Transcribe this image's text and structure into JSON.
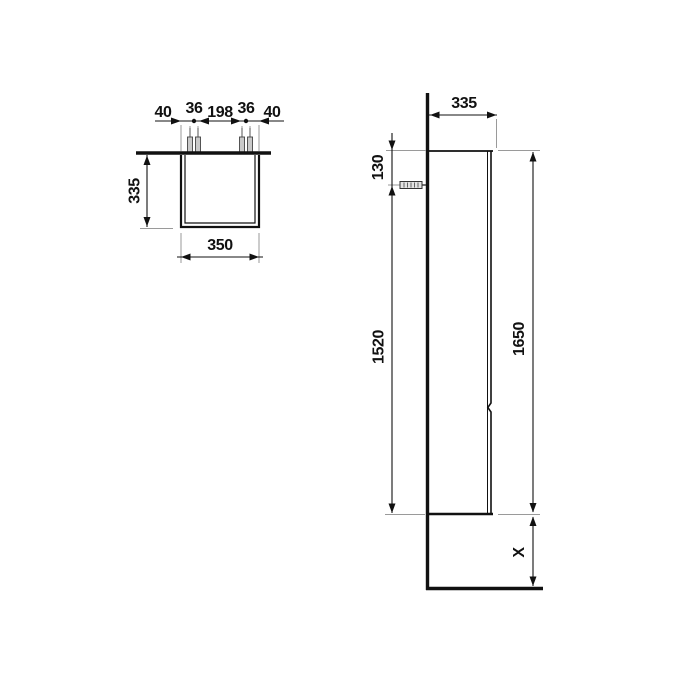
{
  "drawing": {
    "colors": {
      "line": "#111111",
      "extension_line": "#9a9a9a",
      "background": "#ffffff"
    },
    "icons": {
      "wall_fixing": "screw-icon",
      "mounting_bolt": "mounting-pin-icon"
    },
    "top_view": {
      "dim_left_offset": "40",
      "dim_pin_gap_left": "36",
      "dim_pin_span": "198",
      "dim_pin_gap_right": "36",
      "dim_right_offset": "40",
      "dim_depth": "335",
      "dim_width": "350"
    },
    "side_view": {
      "dim_depth": "335",
      "dim_top_to_fixing": "130",
      "dim_fixing_to_bottom": "1520",
      "dim_total_height": "1650",
      "dim_floor_clearance": "X"
    }
  }
}
